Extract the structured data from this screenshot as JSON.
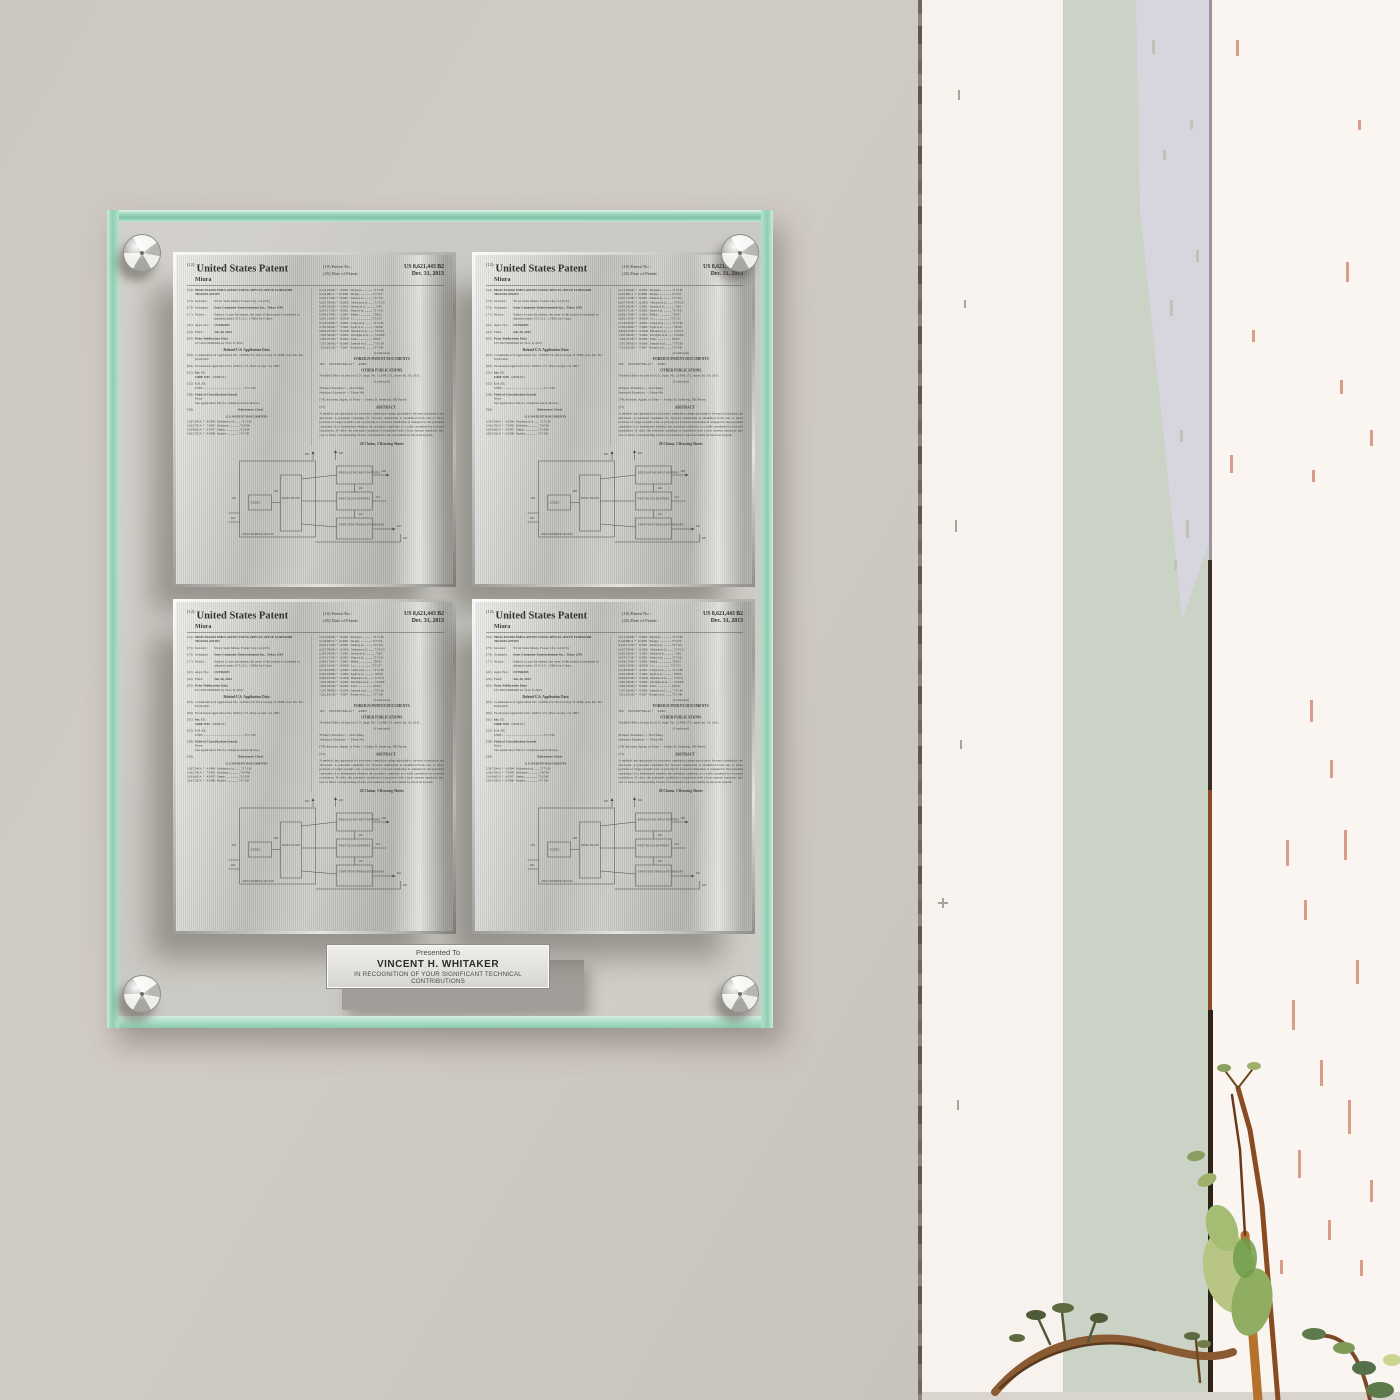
{
  "theme": {
    "wall": "#cdc7c1",
    "glassMint": "#7fc3a6",
    "steel": "#bdbdb9",
    "trimWhite": "#f7f2ee",
    "sage": "#cbd2c6",
    "lavender": "#d8d5de",
    "rightWhite": "#faf5f1",
    "salmon": "#d4947c",
    "stemBrown": "#8a5a32",
    "leafGreen": "#8fae62"
  },
  "nameplate": {
    "presented_to": "Presented To",
    "recipient": "VINCENT H. WHITAKER",
    "recognition": "IN RECOGNITION OF YOUR SIGNIFICANT TECHNICAL CONTRIBUTIONS"
  },
  "patent": {
    "kind_code": "(12)",
    "header_title": "United States Patent",
    "surname": "Miura",
    "patent_no_label": "(10) Patent No.:",
    "patent_no": "US 8,621,443 B2",
    "date_label": "(45) Date of Patent:",
    "date_of_patent": "Dec. 31, 2013",
    "left": {
      "title_num": "(54)",
      "title": "PROCESSOR EMULATION USING SPECULATIVE FORWARD TRANSLATION",
      "inventor_num": "(75)",
      "inventor_label": "Inventor:",
      "inventor": "Victor Suba Miura, Foster City, CA (US)",
      "assignee_num": "(73)",
      "assignee_label": "Assignee:",
      "assignee": "Sony Computer Entertainment Inc., Tokyo (JP)",
      "notice_num": "( * )",
      "notice_label": "Notice:",
      "notice": "Subject to any disclaimer, the term of this patent is extended or adjusted under 35 U.S.C. 154(b) by 0 days.",
      "appl_num": "(21)",
      "appl_label": "Appl. No.:",
      "appl_no": "13/558,003",
      "filed_num": "(22)",
      "filed_label": "Filed:",
      "filed": "Jul. 26, 2012",
      "pub_num": "(65)",
      "pub_heading": "Prior Publication Data",
      "pub_line": "US 2012/0296626 A1          Nov. 8, 2012",
      "related_heading": "Related U.S. Application Data",
      "related_63_num": "(63)",
      "related_63": "Continuation of application No. 12/099,172, filed on Apr. 8, 2008, now Pat. No. 8,245,202.",
      "related_60_num": "(60)",
      "related_60": "Provisional application No. 60/911,171, filed on Apr. 16, 2007.",
      "intcl_num": "(51)",
      "intcl_label": "Int. Cl.",
      "intcl_code": "G06F 9/45",
      "intcl_year": "(2006.01)",
      "uscl_num": "(52)",
      "uscl_label": "U.S. Cl.",
      "uscl_line": "USPC ..............................................  717/136",
      "field_num": "(58)",
      "field_label": "Field of Classification Search",
      "field_line1": "None",
      "field_line2": "See application file for complete search history.",
      "refs_num": "(56)",
      "refs_heading": "References Cited",
      "us_docs_heading": "U.S. PATENT DOCUMENTS",
      "us_refs": [
        "5,307,504 A  *   4/1994   Robinson et al. ....... 717/139",
        "5,432,795 A  *   7/1995   Robinson .............. 714/746",
        "5,619,665 A  *   4/1997   Emma .................. 712/208",
        "5,815,720 A  *   9/1998   Buzbee ................ 717/158"
      ]
    },
    "right": {
      "refs": [
        "6,115,054 B1 *   9/2000   Maynard ............... 717/138",
        "6,142,682 A  *  11/2000   Skogby ................ 717/135",
        "6,247,172 B1 *   6/2001   Dunn et al. ........... 717/141",
        "6,327,704 B1 *  12/2001   Mattson et al. ........ 717/153",
        "6,397,242 B1 *   5/2002   Devine et al. ............ 718/1",
        "6,457,171 B1 *   9/2002   Mann et al. ........... 717/141",
        "6,564,179 B1 *   5/2003   Belhaj ................... 703/25",
        "6,631,514 B1 *  10/2003   Le ...................... 717/137",
        "6,718,539 B1 *   4/2004   Cohen et al. .......... 717/138",
        "6,763,328 B1 *   7/2004   Egolf et al. ............. 703/26",
        "6,820,255 B2 *  11/2004   Babaian et al. ........ 717/151",
        "7,047,394 B1 *   5/2006   Van Dyke et al. ...... 712/209",
        "7,085,705 B2 *   8/2006   Traut .................... 703/27",
        "7,107,580 B2 *   9/2006   Zemach et al. ........ 717/136",
        "7,251,811 B2 *   7/2007   Rosner et al. ......... 717/140"
      ],
      "continued": "(Continued)",
      "foreign_heading": "FOREIGN PATENT DOCUMENTS",
      "foreign_ref": "WO      WO 03/027842 A2 *      4/2003",
      "other_heading": "OTHER PUBLICATIONS",
      "other_text": "Notified Office Action for U.S. Appl. No. 12/099,172, dated Jul. 19, 2011.",
      "continued2": "(Continued)",
      "primary_examiner": "Primary Examiner — Don Wong",
      "assistant_examiner": "Assistant Examiner — Theon Wu",
      "attorney": "(74) Attorney, Agent, or Firm — Joshua D. Isenberg; JDI Patent",
      "abstract_num": "(57)",
      "abstract_heading": "ABSTRACT",
      "abstract": "A method and apparatus for processor emulation using speculative forward translation are disclosed. A potential candidate for forward translation is identified from one or more portions of target system code. A priority for forward translation is assigned to the potential candidate. It is determined whether the potential candidate is a valid candidate for forward translation. If valid, the potential candidate is translated with a host system translator into one or more corresponding blocks of translated code executable by the host system.",
      "claims_line": "20 Claims, 3 Drawing Sheets"
    },
    "diagram": {
      "n100": "100",
      "n102": "102",
      "n104": "104",
      "n106": "106",
      "n108": "108",
      "n110": "110",
      "n112": "112",
      "n114": "114",
      "n116": "116",
      "n118": "118",
      "n120": "120",
      "box_a": "CODEC",
      "box_b": "BASIC BLOCK",
      "s1": "SPECULATIVE INPUT BUFFERS",
      "s2": "FIRST BLOCK BUFFERS",
      "s3": "START ROW TRANSLATE MEMORY",
      "outer_caption": "MAIN INTERNAL BLOCK"
    }
  }
}
